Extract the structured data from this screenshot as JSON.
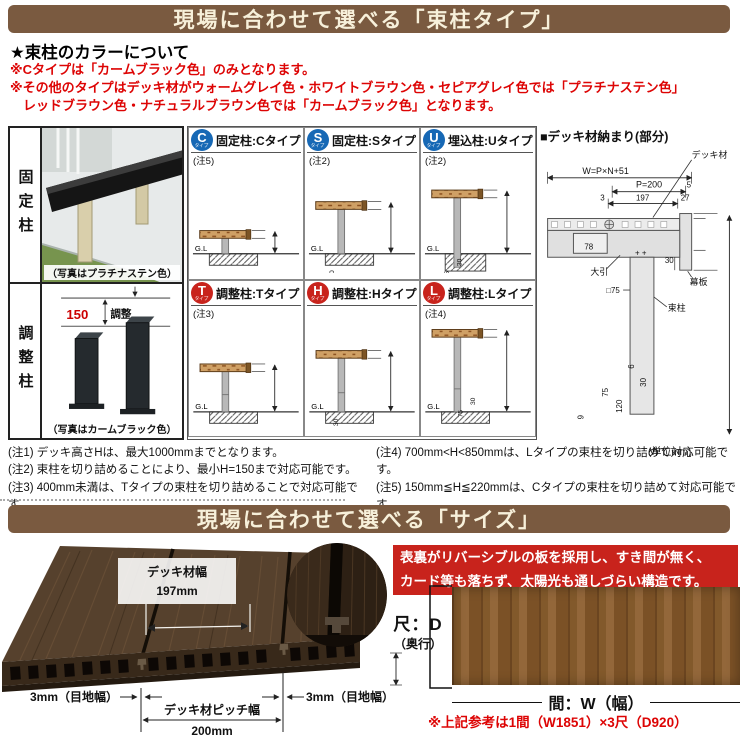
{
  "banner1": "現場に合わせて選べる「束柱タイプ」",
  "banner2": "現場に合わせて選べる「サイズ」",
  "colors": {
    "banner_brown": "#7a5a40",
    "note_red": "#dd0404",
    "badge_blue": "#1668b5",
    "badge_red": "#c8231c",
    "ribbon_red": "#c8231c"
  },
  "color_section": {
    "heading": "★束柱のカラーについて",
    "line1": "※Cタイプは「カームブラック色」のみとなります。",
    "line2": "※その他のタイプはデッキ材がウォームグレイ色・ホワイトブラウン色・セピアグレイ色では「プラチナステン色」",
    "line3": "　レッドブラウン色・ナチュラルブラウン色では「カームブラック色」となります。"
  },
  "post_table": {
    "badge_sub": "タイプ",
    "dims": {
      "top": "30",
      "mid": "75",
      "gl": "G.L"
    },
    "left": {
      "row1": {
        "label": "固定柱",
        "caption": "（写真はプラチナステン色）"
      },
      "row2": {
        "label": "調整柱",
        "caption": "（写真はカームブラック色）",
        "adjust_value": "150",
        "adjust_label": "調整"
      }
    },
    "types": [
      {
        "badge": "C",
        "title": "固定柱:Cタイプ",
        "note": "(注5)",
        "dim_h": "H=170"
      },
      {
        "badge": "S",
        "title": "固定柱:Sタイプ",
        "note": "(注2)",
        "dim_h": "H=550"
      },
      {
        "badge": "U",
        "title": "埋込柱:Uタイプ",
        "note": "(注2)",
        "dim_h": "H=700"
      },
      {
        "badge": "T",
        "title": "調整柱:Tタイプ",
        "note": "(注3)",
        "dim_h": "H=400~550"
      },
      {
        "badge": "H",
        "title": "調整柱:Hタイプ",
        "note": "",
        "dim_h": "H=550~700"
      },
      {
        "badge": "L",
        "title": "調整柱:Lタイプ",
        "note": "(注4)",
        "dim_h": "H=850~1000"
      }
    ],
    "unit": "(単位mm)"
  },
  "detail_panel": {
    "title": "■デッキ材納まり(部分)",
    "labels": {
      "deck": "デッキ材",
      "w_formula": "W=P×N+51",
      "p200": "P=200",
      "d5": "5",
      "d3": "3",
      "d197": "197",
      "d27": "27",
      "d6": "6",
      "d30a": "30",
      "d75": "75",
      "d120": "120",
      "d9": "9",
      "d30b": "30",
      "d78": "78",
      "obiki": "大引",
      "sq75": "□75",
      "makuita": "幕板",
      "tsukabashira": "束柱",
      "height": "デッキ高さH（注1）"
    }
  },
  "footnotes": {
    "left": [
      "(注1) デッキ高さHは、最大1000mmまでとなります。",
      "(注2) 束柱を切り詰めることにより、最小H=150まで対応可能です。",
      "(注3) 400mm未満は、Tタイプの束柱を切り詰めることで対応可能です。"
    ],
    "right": [
      "(注4) 700mm<H<850mmは、Lタイプの束柱を切り詰めて対応可能です。",
      "(注5) 150mm≦H≦220mmは、Cタイプの束柱を切り詰めて対応可能です。"
    ]
  },
  "size_section": {
    "deck_width_label": "デッキ材幅",
    "deck_width_value": "197mm",
    "joint_left": "3mm（目地幅）",
    "joint_right": "3mm（目地幅）",
    "pitch_label": "デッキ材ピッチ幅",
    "pitch_value": "200mm",
    "ribbon_line1": "表裏がリバーシブルの板を採用し、すき間が無く、",
    "ribbon_line2": "カード等も落ちず、太陽光も通しづらい構造です。",
    "depth_label": "尺：D",
    "depth_sub": "（奥行）",
    "thickness": "30mm",
    "width_label": "間：W（幅）",
    "ref_note": "※上記参考は1間（W1851）×3尺（D920）"
  }
}
